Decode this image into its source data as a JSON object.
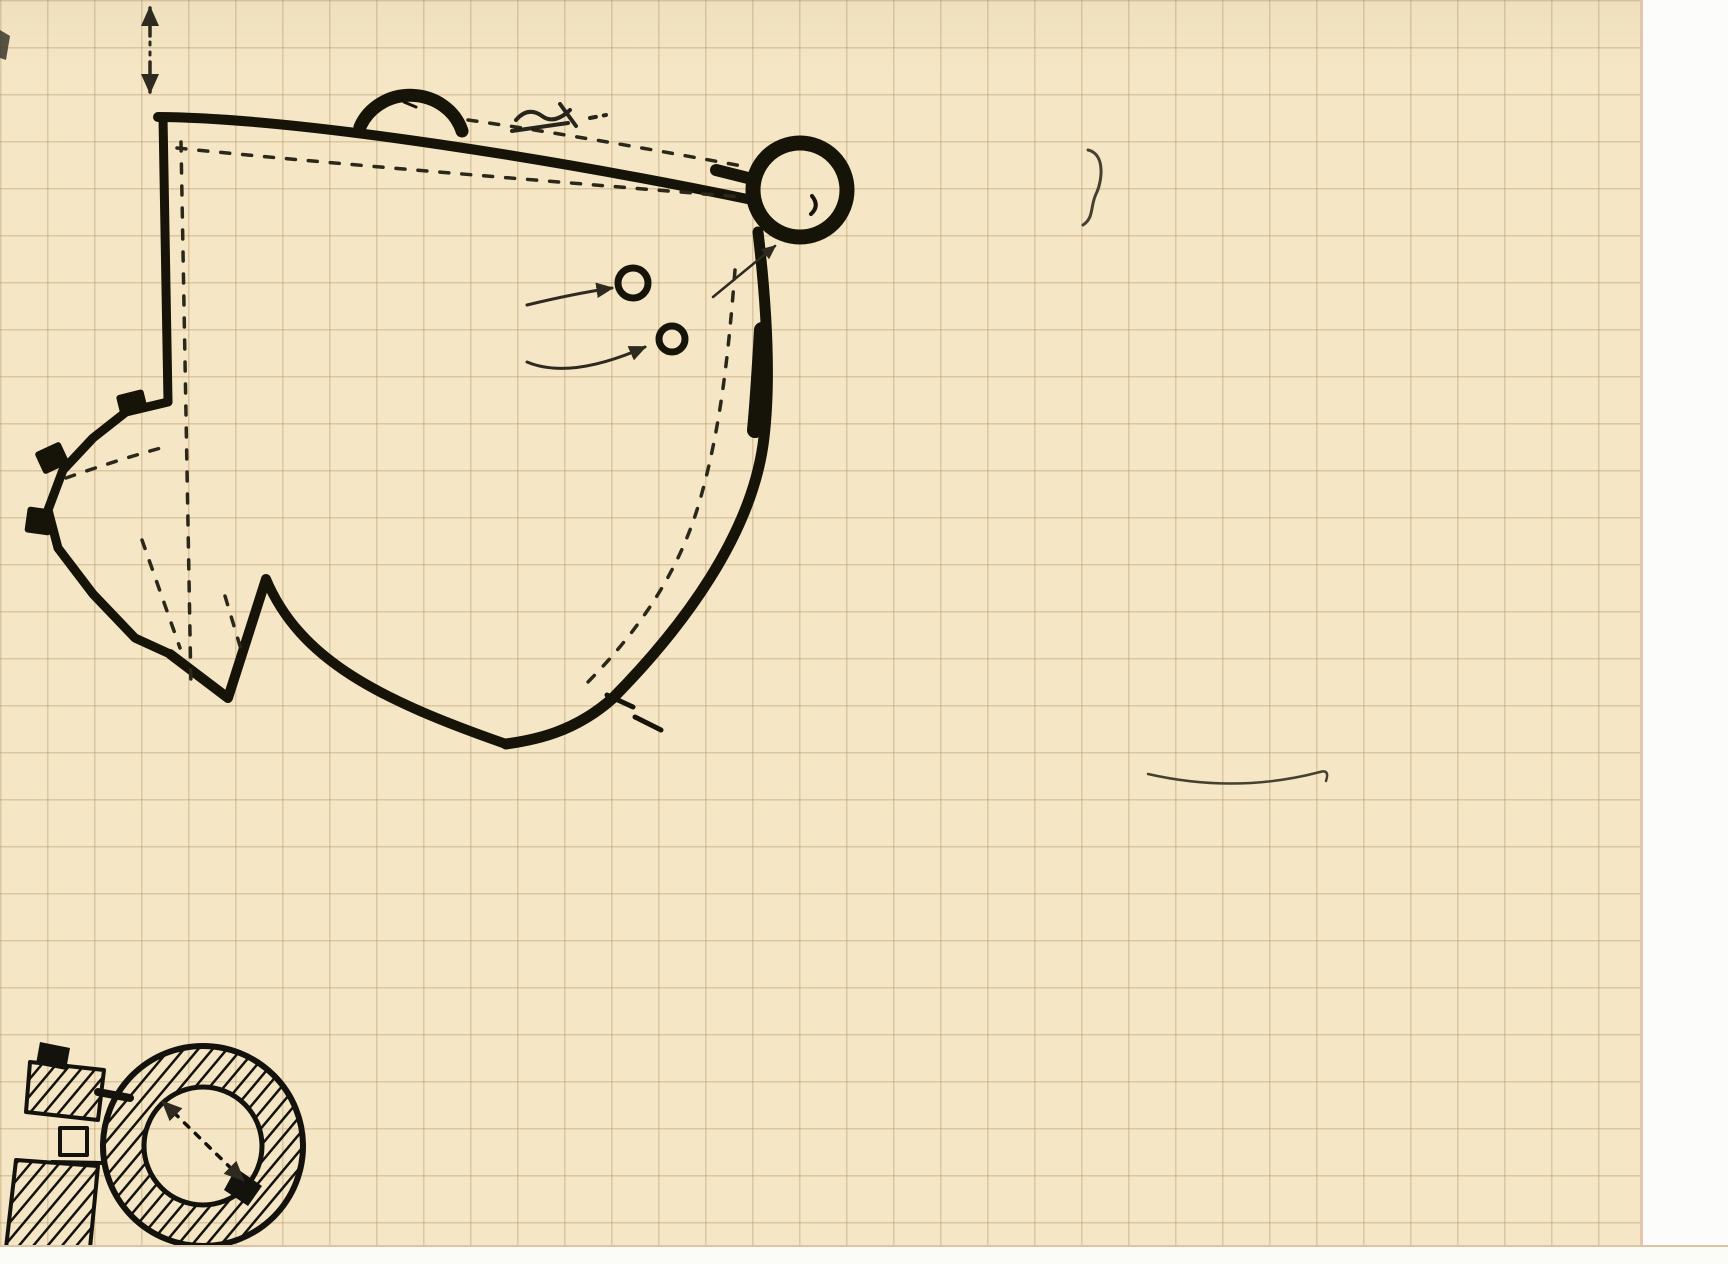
{
  "palette": {
    "paper": "#f5e6c5",
    "grid": "#a78652",
    "ink": "#46402f",
    "plan_ink": "#161309"
  },
  "lines": [
    {
      "n": "title-chateau",
      "x": 895,
      "y": 22,
      "fs": 37,
      "ls": 3,
      "rot": -1,
      "seg": [
        {
          "t": "Château fin du 15ᵉᵐᵉ   "
        },
        {
          "t": "ou extrême",
          "k": 1
        }
      ]
    },
    {
      "n": "line-debut-16",
      "x": 1110,
      "y": 94,
      "fs": 34,
      "ls": 3,
      "rot": -1,
      "seg": [
        {
          "t": "début du 16ᵉ",
          "k": 2
        },
        {
          "t": "  . la date est"
        }
      ]
    },
    {
      "n": "line-donnee-ogives",
      "x": 1128,
      "y": 160,
      "fs": 32,
      "ls": 2,
      "seg": [
        {
          "t": "donnée par les ogives a pené"
        }
      ]
    },
    {
      "n": "line-tration-chapelle",
      "x": 906,
      "y": 212,
      "fs": 32,
      "ls": 2,
      "seg": [
        {
          "t": "tration de la chapelle et par le"
        }
      ]
    },
    {
      "n": "line-blason-porte",
      "x": 904,
      "y": 266,
      "fs": 32,
      "ls": 2,
      "seg": [
        {
          "t": "blason de la porte de la tour N-E"
        }
      ]
    },
    {
      "n": "line-blason-pierre",
      "x": 904,
      "y": 330,
      "fs": 32,
      "ls": 2,
      "seg": [
        {
          "t": "blason de Pierre d'Abzac 21 avril"
        }
      ]
    },
    {
      "n": "line-dates-1494",
      "x": 896,
      "y": 394,
      "fs": 31,
      "ls": 1,
      "seg": [
        {
          "t": "1494 - 23 mai 1502 , arch. de Narbonne"
        }
      ]
    },
    {
      "n": "line-sivade",
      "x": 904,
      "y": 452,
      "fs": 31,
      "ls": 2,
      "seg": [
        {
          "t": "(Sivade p.32) -"
        }
      ]
    },
    {
      "n": "line-le-chateau",
      "x": 794,
      "y": 518,
      "fs": 32,
      "ls": 2,
      "seg": [
        {
          "t": "Le chateau a grossierement la forme"
        }
      ]
    },
    {
      "n": "line-quadrilatere",
      "x": 850,
      "y": 580,
      "fs": 32,
      "ls": 2,
      "seg": [
        {
          "t": "d'un quadrilatere dont  deux angle"
        }
      ]
    },
    {
      "n": "line-opposes",
      "x": 850,
      "y": 632,
      "fs": 32,
      "ls": 2,
      "seg": [
        {
          "t": "opposés sont occupés par une tour"
        }
      ]
    },
    {
      "n": "line-et-la-chapelle",
      "x": 924,
      "y": 690,
      "fs": 32,
      "ls": 2,
      "seg": [
        {
          "t": "et la chapelle ."
        }
      ]
    },
    {
      "n": "line-cote-nord",
      "x": 592,
      "y": 764,
      "fs": 33,
      "ls": 2,
      "seg": [
        {
          "t": "Coté nord long 29ᵐ,10 - "
        },
        {
          "t": "une",
          "k": 1
        },
        {
          "t": " tour ronde  à l'angle"
        }
      ]
    },
    {
      "n": "line-ne-cette-tour",
      "x": 566,
      "y": 820,
      "fs": 32,
      "ls": 2,
      "seg": [
        {
          "t": "N-E .- Cette tour comprenait  un étage sous terre ."
        }
      ]
    },
    {
      "n": "para-orifice",
      "x": 24,
      "y": 868,
      "fs": 30,
      "ls": 1,
      "rot": -0.5,
      "seg": [
        {
          "t": "dont l'orifice carré  existe au milieu de la tour . au dessus à la voute du rez de chaussée"
        }
      ]
    },
    {
      "n": "para-crochet",
      "x": 28,
      "y": 926,
      "fs": 30,
      "ls": 1,
      "seg": [
        {
          "t": "un crochet pour monter sans doute les provisions du sous . sol . - voute spherique en pierre"
        }
      ]
    },
    {
      "n": "para-moellons",
      "x": 28,
      "y": 984,
      "fs": 30,
      "ls": 1,
      "seg": [
        {
          "t": "moellons non taillés . a coté du rez de chaussée des cabinets - 1ᵉʳ étage  avec cabinets à coté"
        }
      ]
    },
    {
      "n": "para-corbeaux",
      "x": 426,
      "y": 1042,
      "fs": 30,
      "ls": 1,
      "seg": [
        {
          "t": "des corbeaux soutenaient le plancher d'un 2ᵉ étage couvert"
        }
      ]
    },
    {
      "n": "para-voute-coupole",
      "x": 436,
      "y": 1102,
      "fs": 30,
      "ls": 1,
      "seg": [
        {
          "t": "d'une voute en coupole comme au rez de chaussée par de cabinets au"
        }
      ]
    },
    {
      "n": "para-2eme",
      "x": 438,
      "y": 1158,
      "fs": 29,
      "ls": 1,
      "seg": [
        {
          "t": "2ᵉᵐᵉ ;— A . sorte placard dans le mur ( carré ) - B cabinets"
        }
      ]
    },
    {
      "n": "para-epaisseur",
      "x": 446,
      "y": 1208,
      "fs": 28,
      "ls": 2,
      "seg": [
        {
          "t": "épaisseur murs de la tour = 90 cent."
        }
      ]
    }
  ],
  "labels": [
    {
      "n": "compass-n-label",
      "t": "N",
      "x": 158,
      "y": -4,
      "fs": 32,
      "b": 1
    },
    {
      "n": "compass-s-label",
      "t": "S",
      "x": 172,
      "y": 56,
      "fs": 30,
      "b": 1
    },
    {
      "n": "dim-north-wall",
      "t": "29,10",
      "x": 374,
      "y": 170,
      "fs": 34,
      "rot": -7
    },
    {
      "n": "label-orifices-line1",
      "t": "orifices",
      "x": 404,
      "y": 284,
      "fs": 27,
      "rot": -7
    },
    {
      "n": "label-orifices-line2",
      "t": "de caves",
      "x": 354,
      "y": 330,
      "fs": 27,
      "rot": -3
    },
    {
      "n": "label-porte-av-blason",
      "t": "porte av. blason",
      "x": 558,
      "y": 366,
      "fs": 24,
      "rot": -41
    },
    {
      "n": "label-o-prime-apostrophe",
      "t": "’",
      "x": 692,
      "y": 312,
      "fs": 34
    },
    {
      "n": "label-chapelle",
      "t": "chapelle",
      "x": 192,
      "y": 524,
      "fs": 26,
      "rot": -2
    },
    {
      "n": "dim-chapelle-4-60",
      "t": "4,60",
      "x": 84,
      "y": 464,
      "fs": 23,
      "rot": -16
    },
    {
      "n": "dim-west-27-50",
      "t": "27,50",
      "x": 200,
      "y": 520,
      "fs": 24,
      "rot": -82,
      "ls": 6
    },
    {
      "n": "dim-chapelle-13-25",
      "t": "13,25",
      "x": 138,
      "y": 618,
      "fs": 23,
      "rot": -76,
      "ls": 3
    },
    {
      "n": "dim-6m",
      "t": "6 ᵐ",
      "x": 208,
      "y": 664,
      "fs": 23,
      "rot": -75
    },
    {
      "n": "dim-10m",
      "t": "10 ᵐ",
      "x": 489,
      "y": 684,
      "fs": 24,
      "rot": 192
    },
    {
      "n": "dim-east-26m80",
      "t": "26 ᵐ80",
      "x": 648,
      "y": 596,
      "fs": 25,
      "rot": -68,
      "ls": 2
    },
    {
      "n": "label-porte-actuelle",
      "t": "porte actuelle .",
      "x": 666,
      "y": 680,
      "fs": 26
    },
    {
      "n": "label-f-chapel-top",
      "t": "F",
      "x": 64,
      "y": 394,
      "fs": 32,
      "b": 1
    },
    {
      "n": "label-f-chapel-left",
      "t": "F",
      "x": 22,
      "y": 542,
      "fs": 31,
      "b": 1,
      "rot": -18
    },
    {
      "n": "label-tour-du-ne",
      "t": "tour du N-E",
      "x": 908,
      "y": 158,
      "fs": 28
    },
    {
      "n": "annotation-13m70",
      "t": "(13ᵐ,70 och.",
      "x": 1140,
      "y": 724,
      "fs": 27,
      "rot": -3
    },
    {
      "n": "label-f-detail-left",
      "t": "F",
      "x": 60,
      "y": 1062,
      "fs": 31,
      "b": 1
    },
    {
      "n": "label-f-detail-top",
      "t": "F",
      "x": 281,
      "y": 1032,
      "fs": 35,
      "b": 1
    },
    {
      "n": "label-detail-a",
      "t": "A",
      "x": 140,
      "y": 1112,
      "fs": 30,
      "b": 1
    },
    {
      "n": "dim-detail-3m70",
      "t": "3ᵐ,70",
      "x": 176,
      "y": 1096,
      "fs": 24,
      "rot": 38
    },
    {
      "n": "label-detail-o",
      "t": "O",
      "x": 67,
      "y": 1129,
      "fs": 21,
      "b": 1
    },
    {
      "n": "label-detail-b",
      "t": "B",
      "x": 70,
      "y": 1160,
      "fs": 31,
      "b": 1
    },
    {
      "n": "label-f-bouchee-f",
      "t": "F",
      "x": 288,
      "y": 1150,
      "fs": 34,
      "b": 1
    },
    {
      "n": "label-f-bouchee-text",
      "t": "bouchée",
      "x": 324,
      "y": 1164,
      "fs": 26
    }
  ]
}
